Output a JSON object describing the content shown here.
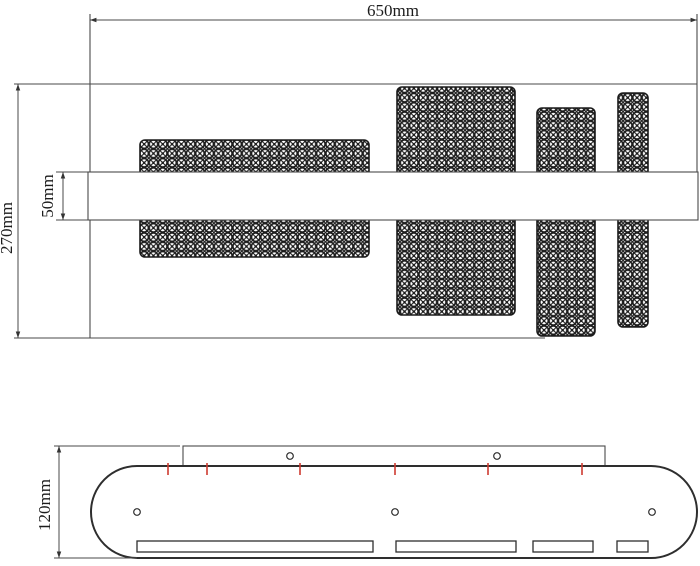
{
  "drawing_type": "technical-drawing",
  "colors": {
    "background": "#ffffff",
    "line": "#4a4a4a",
    "outline": "#2e2e2e",
    "hatch": "#1b1b1b",
    "tick_red": "#cf3b30",
    "text": "#1c1c1c"
  },
  "dimensions": {
    "top_width": "650mm",
    "top_height": "270mm",
    "bar_width": "50mm",
    "side_height": "120mm"
  },
  "top_view": {
    "bar": {
      "x": 88,
      "y": 172,
      "w": 610,
      "h": 48
    },
    "blocks": [
      {
        "x": 140,
        "y": 140,
        "w": 229,
        "h": 117
      },
      {
        "x": 397,
        "y": 87,
        "w": 118,
        "h": 228
      },
      {
        "x": 537,
        "y": 108,
        "w": 58,
        "h": 228
      },
      {
        "x": 618,
        "y": 93,
        "w": 30,
        "h": 234
      }
    ]
  },
  "side_view": {
    "body": {
      "x": 91,
      "y": 466,
      "w": 606,
      "h": 92,
      "r": 46
    },
    "plate": {
      "x": 183,
      "y": 446,
      "w": 422,
      "h": 20
    },
    "plate_holes": [
      {
        "cx": 290,
        "cy": 456
      },
      {
        "cx": 497,
        "cy": 456
      }
    ],
    "body_holes": [
      {
        "cx": 137,
        "cy": 512
      },
      {
        "cx": 395,
        "cy": 512
      },
      {
        "cx": 652,
        "cy": 512
      }
    ],
    "hole_radius": 3.3,
    "red_ticks": [
      168,
      207,
      300,
      395,
      488,
      582
    ],
    "tick_y1": 463,
    "tick_y2": 475,
    "slots": [
      {
        "x": 137,
        "w": 236
      },
      {
        "x": 396,
        "w": 120
      },
      {
        "x": 533,
        "w": 60
      },
      {
        "x": 617,
        "w": 31
      }
    ],
    "slot_y": 541,
    "slot_h": 11
  }
}
